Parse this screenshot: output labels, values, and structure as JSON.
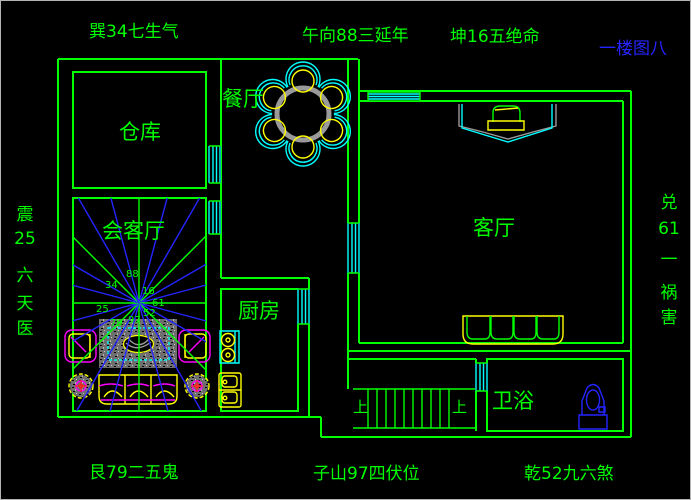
{
  "drawing_title": "一楼图八",
  "top_labels": [
    "巽34七生气",
    "午向88三延年",
    "坤16五绝命"
  ],
  "left_labels": [
    "震",
    "25",
    "六",
    "天",
    "医"
  ],
  "right_labels": [
    "兑",
    "61",
    "一",
    "祸",
    "害"
  ],
  "bottom_labels": [
    "艮79二五鬼",
    "子山97四伏位",
    "乾52九六煞"
  ],
  "rooms": {
    "storage": "仓库",
    "dining": "餐厅",
    "reception": "会客厅",
    "kitchen": "厨房",
    "living": "客厅",
    "bath": "卫浴"
  },
  "stairs_up": "上",
  "fan_numbers": [
    "34",
    "88",
    "16",
    "25",
    "61",
    "52",
    "97",
    "79"
  ],
  "colors": {
    "bg": "#000000",
    "green": "#00ff00",
    "cyan": "#00ffff",
    "yellow": "#ffff00",
    "magenta": "#ff00ff",
    "blue": "#2424ff",
    "gray": "#9a9a9a",
    "red": "#ff2020"
  }
}
